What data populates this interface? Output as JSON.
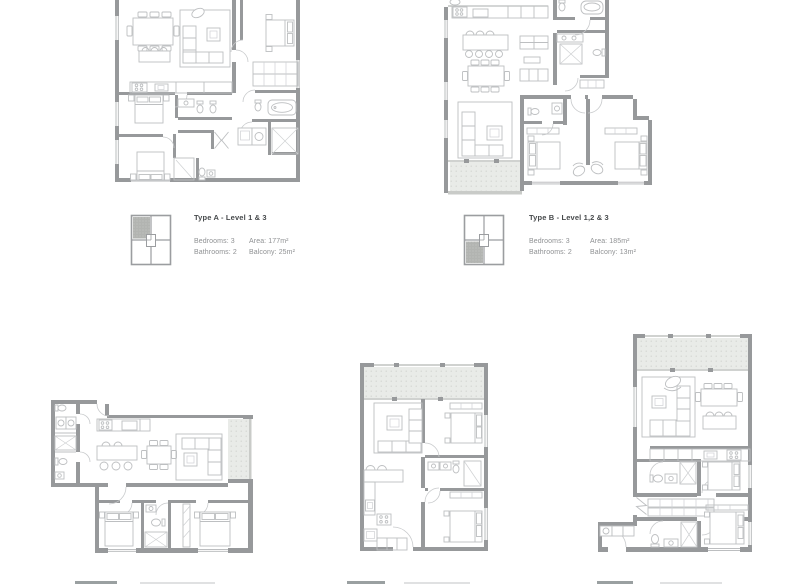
{
  "document": {
    "background": "#ffffff"
  },
  "colors": {
    "wall": "#97999b",
    "furniture_line": "#bdbfc1",
    "balcony_fill": "#e9ebe8",
    "balcony_dot": "#d3d5d2",
    "rail": "#c9cbc8",
    "keyplan_outline": "#9b9da0",
    "keyplan_highlight": "#b2b4b1",
    "title_text": "#474a4c",
    "body_text": "#8f9193"
  },
  "legends": [
    {
      "id": "type-a",
      "title": "Type A - Level 1 & 3",
      "bedrooms": "Bedrooms: 3",
      "bathrooms": "Bathrooms: 2",
      "area": "Area: 177m²",
      "balcony": "Balcony: 25m²",
      "highlighted_unit": "top-left"
    },
    {
      "id": "type-b",
      "title": "Type B - Level 1,2 & 3",
      "bedrooms": "Bedrooms: 3",
      "bathrooms": "Bathrooms: 2",
      "area": "Area: 185m²",
      "balcony": "Balcony: 13m²",
      "highlighted_unit": "bottom-left"
    }
  ],
  "floorplans": [
    {
      "id": "floorplan-type-a",
      "position": "top-left"
    },
    {
      "id": "floorplan-type-b",
      "position": "top-right"
    },
    {
      "id": "floorplan-bottom-left",
      "position": "bottom-left"
    },
    {
      "id": "floorplan-bottom-middle",
      "position": "bottom-middle"
    },
    {
      "id": "floorplan-bottom-right",
      "position": "bottom-right"
    }
  ],
  "cutoff_legends": {
    "count": 3
  }
}
